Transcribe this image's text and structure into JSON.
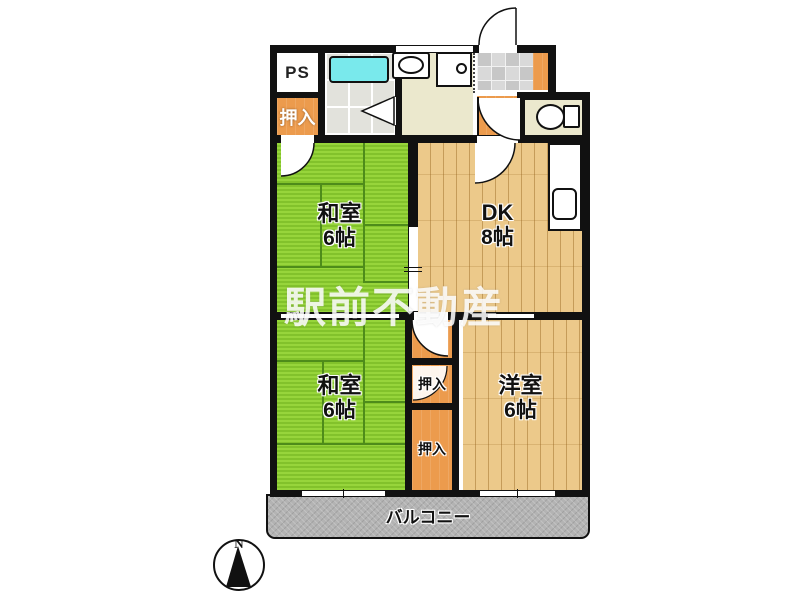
{
  "plan": {
    "watermark": "駅前不動産",
    "compass": {
      "north": "N"
    },
    "rooms": {
      "ps": {
        "label": "PS"
      },
      "closet_top": {
        "label": "押入"
      },
      "washitsu_upper": {
        "name": "和室",
        "size": "6帖"
      },
      "dk": {
        "name": "DK",
        "size": "8帖"
      },
      "washitsu_lower": {
        "name": "和室",
        "size": "6帖"
      },
      "closet_mid_upper": {
        "label": "押入"
      },
      "closet_mid_lower": {
        "label": "押入"
      },
      "yoshitsu": {
        "name": "洋室",
        "size": "6帖"
      },
      "balcony": {
        "label": "バルコニー"
      }
    },
    "colors": {
      "wall": "#111111",
      "tatami": "#8cc832",
      "tatami_line": "#4e8c1a",
      "wood": "#ecc98a",
      "closet_orange": "#ec9b4d",
      "utility_floor": "#ebe8cd",
      "bathtub": "#79e9ec",
      "balcony": "#b3b3b3",
      "watermark": "#ffffff"
    }
  }
}
